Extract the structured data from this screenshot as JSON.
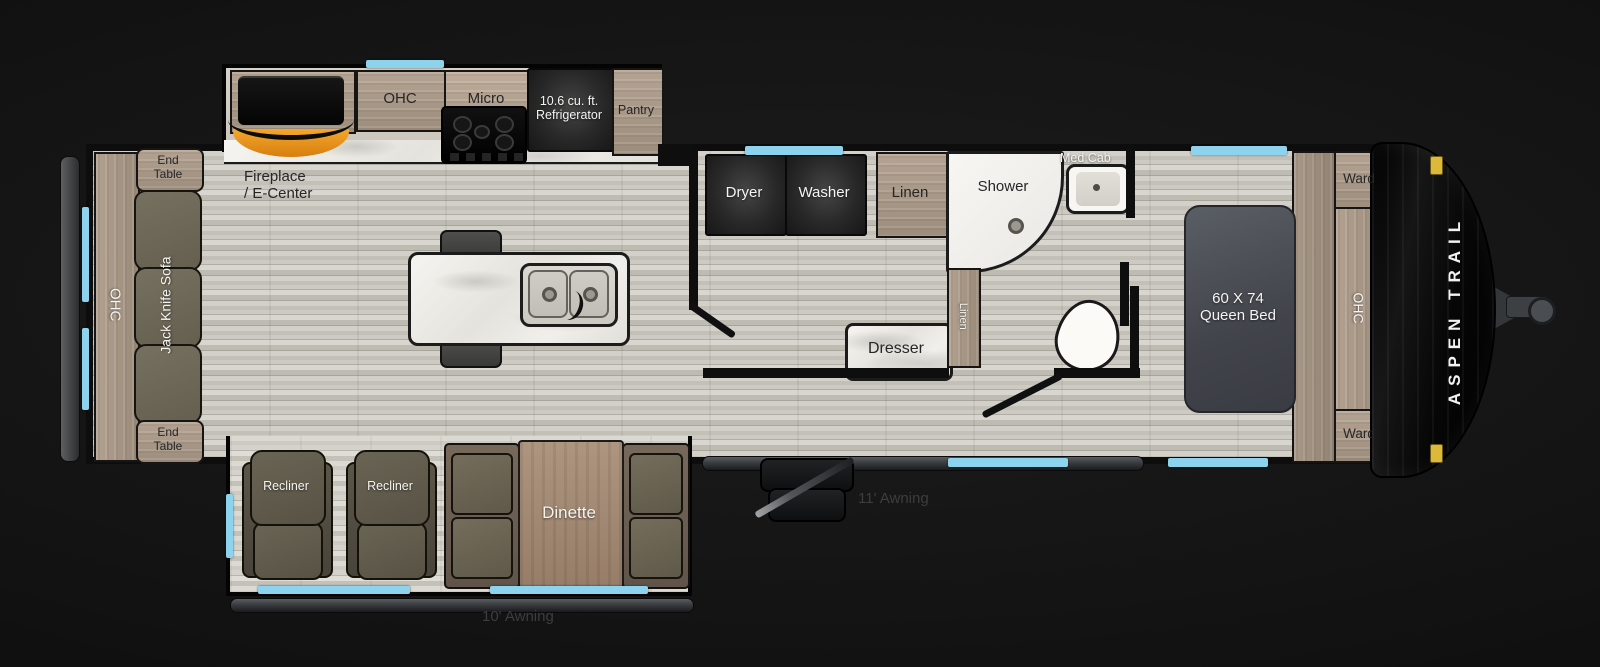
{
  "plan_type": "travel-trailer-floorplan",
  "colors": {
    "background": "#141414",
    "floor_wood": "#cfccc4",
    "cabinet_wood": "#a8977f",
    "appliance_black": "#1f1f1f",
    "window_blue": "#8ed3ee",
    "fireplace_glow": "#e8921c",
    "marker_light": "#ddb93a",
    "sofa_gray": "#6e6a5c",
    "bed_gray": "#4a4e54",
    "label_dark": "#262626",
    "label_light": "#f4f4f1"
  },
  "plan": {
    "rear": {
      "end_table_line1": "End",
      "end_table_line2": "Table",
      "ohc": "OHC",
      "sofa": "Jack Knife Sofa"
    },
    "kitchen": {
      "fireplace_line1": "Fireplace",
      "fireplace_line2": "/ E-Center",
      "ohc": "OHC",
      "micro": "Micro",
      "fridge_line1": "10.6 cu. ft.",
      "fridge_line2": "Refrigerator",
      "pantry": "Pantry"
    },
    "laundry": {
      "dryer": "Dryer",
      "washer": "Washer",
      "linen": "Linen"
    },
    "bath": {
      "shower": "Shower",
      "med_cab": "Med Cab"
    },
    "bedroom": {
      "dresser": "Dresser",
      "linen": "Linen",
      "bed_line1": "60 X 74",
      "bed_line2": "Queen Bed",
      "ward_top": "Ward",
      "ohc": "OHC",
      "ward_bottom": "Ward"
    },
    "living": {
      "recliner_left": "Recliner",
      "recliner_right": "Recliner",
      "dinette": "Dinette"
    },
    "exterior": {
      "brand": "ASPEN TRAIL",
      "awning_main": "11' Awning",
      "awning_slide": "10' Awning"
    }
  }
}
